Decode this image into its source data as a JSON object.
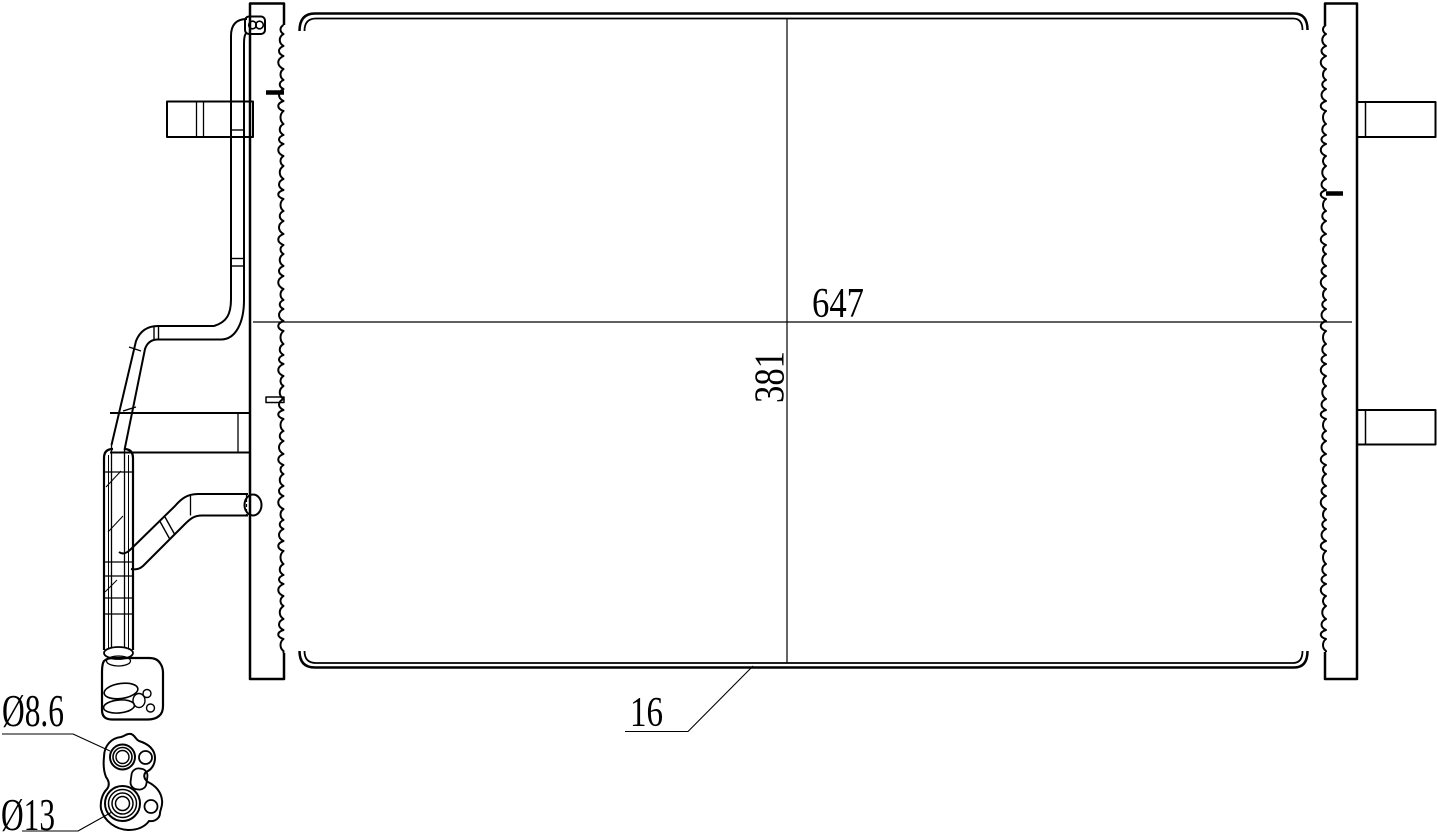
{
  "drawing": {
    "background_color": "#ffffff",
    "line_color": "#000000",
    "dimensions": [
      {
        "id": "core-width",
        "label": "647",
        "orientation": "horizontal"
      },
      {
        "id": "core-height",
        "label": "381",
        "orientation": "vertical"
      },
      {
        "id": "core-depth",
        "label": "16",
        "orientation": "leader"
      },
      {
        "id": "port-small-diameter",
        "label": "Ø8.6",
        "orientation": "leader"
      },
      {
        "id": "port-large-diameter",
        "label": "Ø13",
        "orientation": "leader"
      }
    ]
  }
}
